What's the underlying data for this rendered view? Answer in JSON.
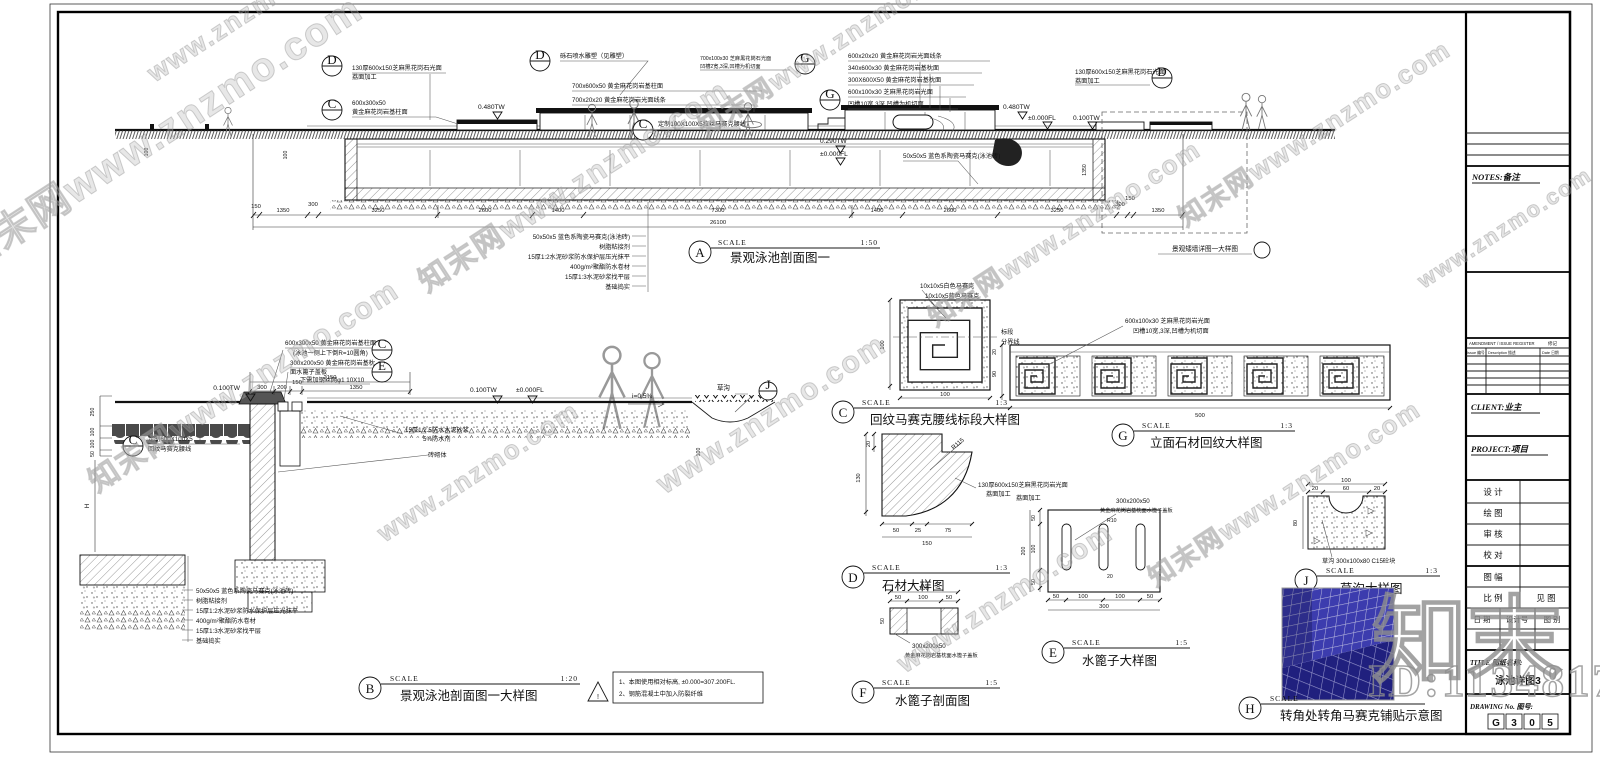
{
  "wm": {
    "site": "知末网www.znzmo.com",
    "short": "www.znzmo.com",
    "brand": "知末",
    "id": "ID:1134817635"
  },
  "sw": "SCALE",
  "cal": {
    "c": "C",
    "d": "D",
    "e": "E",
    "g": "G",
    "j": "J"
  },
  "layers": [
    "50x50x5 蓝色系陶瓷马赛克(泳池砖)",
    "树脂粘接剂",
    "15厚1:2水泥砂浆防水保护层压光抹平",
    "400g/m²聚酯防水卷材",
    "15厚1:3水泥砂浆找平层",
    "基础捣实"
  ],
  "sec": {
    "a": {
      "l": "A",
      "r": "1:50",
      "name": "景观泳池剖面图一",
      "total": "26100",
      "dm": [
        "150",
        "1350",
        "300",
        "3250",
        "2600",
        "1400",
        "7300",
        "1400",
        "2600",
        "3250",
        "300",
        "150",
        "1350"
      ],
      "dv": [
        "100",
        "100",
        "1350"
      ],
      "an": [
        "130厚600x150芝麻黑花岗石光面",
        "荔面加工",
        "600x300x50",
        "黄金麻花岗岩基柱面",
        "砾石喷水雕塑（见雕塑）",
        "700x600x50 黄金麻花岗岩基柱面",
        "700x20x20 黄金麻花岗岩光面线条",
        "0.480TW",
        "700x100x30 芝麻黑花岗石光面",
        "凹槽2宽,3深,凹槽为机切面",
        "定制100X100X5拉丝马赛克腰线",
        "0.290TW",
        "±0.000FL",
        "600x20x20 黄金麻花岗岩光面线条",
        "340x600x30 黄金麻花岗岩基枕面",
        "300X600X50 黄金麻花岗岩基枕面",
        "600x100x30 芝麻黑花岗岩光面",
        "凹槽10宽,3深,凹槽为机切面",
        "0.480TW",
        "±0.000FL",
        "0.100TW",
        "130厚600x150芝麻黑花岗石光面",
        "荔面加工",
        "50x50x5 蓝色系陶瓷马赛克(泳池砖)"
      ],
      "box": "景观矮墙详图一大样图"
    },
    "b": {
      "l": "B",
      "r": "1:20",
      "name": "景观泳池剖面图一大样图",
      "dm": [
        "2150",
        "300",
        "200",
        "150",
        "1350",
        "250",
        "100",
        "100",
        "50",
        "H",
        "100"
      ],
      "an": [
        "600x300x50 黄金麻花岗岩基柱面",
        "(泳池一侧上下倒R=10圆角)",
        "300x200x50 黄金麻花岗岩基枕",
        "面水篦子盖板",
        "下需加钢丝网φ1 10X10",
        "0.100TW",
        "0.100TW",
        "±0.000FL",
        "i=0.5%",
        "草沟",
        "定制600X100X5",
        "回纹马赛克腰线",
        "15厚1:2.5防水水泥砂浆",
        "5%防水剂",
        "砖砌体"
      ],
      "warn": "!",
      "note1": "1、本图使用相对标高, ±0.000=307.200FL.",
      "note2": "2、钢筋混凝土中加入防裂纤维"
    },
    "c": {
      "l": "C",
      "r": "1:3",
      "name": "回纹马赛克腰线标段大样图",
      "dm": [
        "100",
        "100"
      ],
      "an": [
        "10x10x5白色马赛克",
        "10x10x5蓝色马赛克",
        "标段",
        "分界线"
      ]
    },
    "g": {
      "l": "G",
      "r": "1:3",
      "name": "立面石材回纹大样图",
      "dm": [
        "90",
        "20",
        "500"
      ],
      "an": [
        "600x100x30 芝麻黑花岗岩光面",
        "凹槽10宽,3深,凹槽为机切面"
      ]
    },
    "d": {
      "l": "D",
      "r": "1:3",
      "name": "石材大样图",
      "dm": [
        "20",
        "130",
        "50",
        "25",
        "75",
        "150",
        "R115"
      ],
      "an": [
        "130厚600x150芝麻黑花岗岩光面",
        "荔面加工"
      ]
    },
    "e": {
      "l": "E",
      "r": "1:5",
      "name": "水篦子大样图",
      "dm": [
        "50",
        "100",
        "50",
        "200",
        "50",
        "100",
        "100",
        "50",
        "300",
        "R10",
        "20"
      ],
      "an": [
        "荔面加工",
        "300x200x50",
        "黄金麻花岗岩基枕面水篦子盖板"
      ]
    },
    "f": {
      "l": "F",
      "r": "1:5",
      "name": "水篦子剖面图",
      "dm": [
        "200",
        "50",
        "100",
        "50",
        "50"
      ],
      "an": [
        "300x200x50",
        "黄金麻花岗岩基枕面水篦子盖板"
      ]
    },
    "j": {
      "l": "J",
      "r": "1:3",
      "name": "草沟大样图",
      "dm": [
        "100",
        "20",
        "60",
        "20",
        "80"
      ],
      "an": [
        "草沟 300x100x80 C15砼块"
      ]
    },
    "h": {
      "l": "H",
      "name": "转角处转角马赛克铺贴示意图"
    }
  },
  "tb": {
    "notes": "NOTES:备注",
    "amend": "AMENDMENT / ISSUE REGISTER",
    "amend_cn": "修记",
    "col_issue": "Issue 编号",
    "col_desc": "Description 描述",
    "col_date": "Date 日期",
    "client": "CLIENT:业主",
    "project": "PROJECT:项目",
    "r1": "设 计",
    "r2": "绘 图",
    "r3": "审 核",
    "r4": "校 对",
    "r5": "图 幅",
    "r6": "比 例",
    "r6v": "见 图",
    "r7": "日 期",
    "r8": "设计号",
    "r9": "图 别",
    "title_label": "TITLE 图纸名称:",
    "title_value": "泳池详图3",
    "dno_label": "DRAWING No. 图号:",
    "cells": [
      "G",
      "3",
      "0",
      "5"
    ]
  }
}
